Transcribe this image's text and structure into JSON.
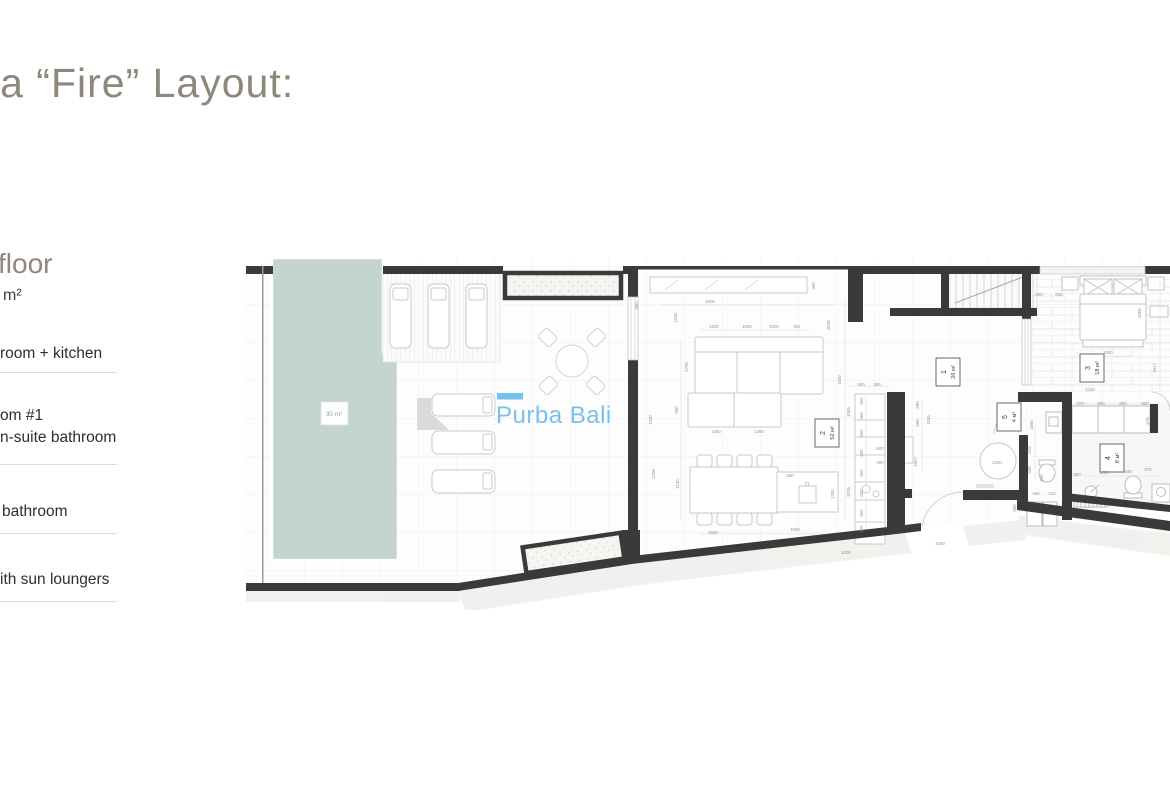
{
  "page": {
    "title": "la “Fire” Layout:"
  },
  "sidebar": {
    "floor_heading": "floor",
    "floor_area": "m²",
    "item_living": "room + kitchen",
    "item_bedroom_line1": "om #1",
    "item_bedroom_line2": "n-suite bathroom",
    "item_bathroom": "bathroom",
    "item_terrace": "ith sun loungers"
  },
  "plan": {
    "watermark": "Purba Bali",
    "pool_label": "30 m²",
    "colors": {
      "pool": "#c4d4d1",
      "wall": "#3a3a3a",
      "watermark_blue": "#79c0ea",
      "title_gray": "#8e877b"
    },
    "rooms": [
      {
        "num": "1",
        "area": "26 м²",
        "x": 936,
        "y": 358
      },
      {
        "num": "2",
        "area": "52 м²",
        "x": 815,
        "y": 419
      },
      {
        "num": "3",
        "area": "18 м²",
        "x": 1080,
        "y": 354
      },
      {
        "num": "4",
        "area": "8 м²",
        "x": 1100,
        "y": 444
      },
      {
        "num": "5",
        "area": "4 м²",
        "x": 997,
        "y": 403
      }
    ],
    "dimensions": [
      [
        710,
        303,
        "4500",
        0
      ],
      [
        815,
        286,
        "400",
        1
      ],
      [
        638,
        306,
        "380",
        1
      ],
      [
        677,
        318,
        "1338",
        1
      ],
      [
        830,
        325,
        "2030",
        1
      ],
      [
        714,
        328,
        "1200",
        0
      ],
      [
        747,
        328,
        "1000",
        0
      ],
      [
        774,
        328,
        "1000",
        0
      ],
      [
        797,
        328,
        "401",
        0
      ],
      [
        688,
        367,
        "1700",
        1
      ],
      [
        841,
        380,
        "1600",
        1
      ],
      [
        678,
        410,
        "600",
        1
      ],
      [
        716,
        433,
        "1300",
        0
      ],
      [
        759,
        433,
        "1300",
        0
      ],
      [
        652,
        420,
        "1430",
        1
      ],
      [
        679,
        484,
        "1140",
        1
      ],
      [
        655,
        474,
        "1208",
        1
      ],
      [
        713,
        534,
        "2500",
        0
      ],
      [
        795,
        531,
        "1800",
        0
      ],
      [
        834,
        494,
        "1200",
        1
      ],
      [
        790,
        477,
        "550",
        0
      ],
      [
        850,
        492,
        "2025",
        1
      ],
      [
        850,
        412,
        "1365",
        1
      ],
      [
        863,
        401,
        "500",
        1
      ],
      [
        863,
        416,
        "365",
        1
      ],
      [
        863,
        433,
        "500",
        1
      ],
      [
        863,
        453,
        "600",
        1
      ],
      [
        863,
        473,
        "600",
        1
      ],
      [
        863,
        493,
        "600",
        1
      ],
      [
        863,
        513,
        "600",
        1
      ],
      [
        863,
        529,
        "425",
        1
      ],
      [
        861,
        386,
        "500",
        0
      ],
      [
        877,
        386,
        "385",
        0
      ],
      [
        880,
        450,
        "600",
        0
      ],
      [
        880,
        464,
        "300",
        0
      ],
      [
        846,
        554,
        "1000",
        0
      ],
      [
        940,
        545,
        "1000",
        0
      ],
      [
        919,
        405,
        "590",
        1
      ],
      [
        919,
        423,
        "595",
        1
      ],
      [
        930,
        420,
        "1185",
        1
      ],
      [
        917,
        462,
        "1507",
        1
      ],
      [
        997,
        464,
        "1000",
        0
      ],
      [
        1016,
        508,
        "560",
        1
      ],
      [
        1033,
        425,
        "1550",
        1
      ],
      [
        1031,
        450,
        "515",
        1
      ],
      [
        1031,
        470,
        "340",
        1
      ],
      [
        1036,
        495,
        "440",
        0
      ],
      [
        1052,
        495,
        "410",
        0
      ],
      [
        1141,
        313,
        "2000",
        1
      ],
      [
        1108,
        354,
        "1600",
        0
      ],
      [
        1156,
        368,
        "1817",
        1
      ],
      [
        1039,
        296,
        "850",
        0
      ],
      [
        1059,
        296,
        "840",
        0
      ],
      [
        1090,
        391,
        "2110",
        0
      ],
      [
        1080,
        405,
        "370",
        0
      ],
      [
        1101,
        405,
        "800",
        0
      ],
      [
        1123,
        405,
        "800",
        0
      ],
      [
        1145,
        405,
        "800",
        0
      ],
      [
        1149,
        421,
        "575",
        1
      ],
      [
        1077,
        476,
        "800",
        0
      ],
      [
        1104,
        474,
        "1200",
        0
      ],
      [
        1128,
        473,
        "340",
        0
      ],
      [
        1148,
        471,
        "375",
        0
      ],
      [
        1043,
        478,
        "600",
        1
      ]
    ]
  }
}
